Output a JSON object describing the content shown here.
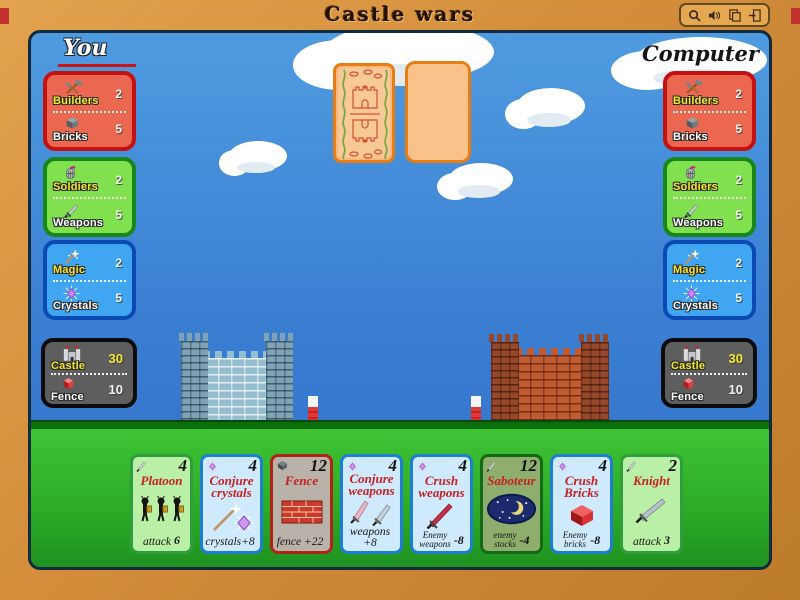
{
  "window": {
    "title": "Castle wars",
    "toolbar": [
      "zoom",
      "sound",
      "cards",
      "exit"
    ]
  },
  "you": {
    "label": "You",
    "panels": [
      {
        "name": "builders-bricks",
        "top_icon": "builders-icon",
        "top_label": "Builders",
        "top_value": "2",
        "bottom_icon": "bricks-icon",
        "bottom_label": "Bricks",
        "bottom_value": "5"
      },
      {
        "name": "soldiers-weapons",
        "top_icon": "soldiers-icon",
        "top_label": "Soldiers",
        "top_value": "2",
        "bottom_icon": "weapons-icon",
        "bottom_label": "Weapons",
        "bottom_value": "5"
      },
      {
        "name": "magic-crystals",
        "top_icon": "magic-icon",
        "top_label": "Magic",
        "top_value": "2",
        "bottom_icon": "crystals-icon",
        "bottom_label": "Crystals",
        "bottom_value": "5"
      },
      {
        "name": "castle-fence",
        "top_icon": "castle-icon",
        "top_label": "Castle",
        "top_value": "30",
        "bottom_icon": "fence-icon",
        "bottom_label": "Fence",
        "bottom_value": "10"
      }
    ]
  },
  "computer": {
    "label": "Computer",
    "panels": [
      {
        "name": "builders-bricks",
        "top_icon": "builders-icon",
        "top_label": "Builders",
        "top_value": "2",
        "bottom_icon": "bricks-icon",
        "bottom_label": "Bricks",
        "bottom_value": "5"
      },
      {
        "name": "soldiers-weapons",
        "top_icon": "soldiers-icon",
        "top_label": "Soldiers",
        "top_value": "2",
        "bottom_icon": "weapons-icon",
        "bottom_label": "Weapons",
        "bottom_value": "5"
      },
      {
        "name": "magic-crystals",
        "top_icon": "magic-icon",
        "top_label": "Magic",
        "top_value": "2",
        "bottom_icon": "crystals-icon",
        "bottom_label": "Crystals",
        "bottom_value": "5"
      },
      {
        "name": "castle-fence",
        "top_icon": "castle-icon",
        "top_label": "Castle",
        "top_value": "30",
        "bottom_icon": "fence-icon",
        "bottom_label": "Fence",
        "bottom_value": "10"
      }
    ]
  },
  "board": {
    "deck_card": "card-back",
    "discard_card": "blank",
    "left_castle_color": "#94bdd0",
    "right_castle_color": "#c05c32"
  },
  "hand": {
    "cards": [
      {
        "title": "Platoon",
        "value": "4",
        "cost_icon": "sword-icon",
        "art": "soldiers",
        "effect_label": "attack",
        "effect_value": "6",
        "color": "green"
      },
      {
        "title": "Conjure crystals",
        "value": "4",
        "cost_icon": "crystal-icon",
        "art": "wand-crystal",
        "effect_label": "crystals+8",
        "effect_value": "",
        "color": "blue"
      },
      {
        "title": "Fence",
        "value": "12",
        "cost_icon": "brick-icon",
        "art": "brick-wall",
        "effect_label": "fence +22",
        "effect_value": "",
        "color": "gray"
      },
      {
        "title": "Conjure weapons",
        "value": "4",
        "cost_icon": "crystal-icon",
        "art": "two-swords",
        "effect_label": "weapons +8",
        "effect_value": "",
        "color": "blue"
      },
      {
        "title": "Crush weapons",
        "value": "4",
        "cost_icon": "crystal-icon",
        "art": "red-sword",
        "effect_label": "Enemy\nweapons",
        "effect_value": "-8",
        "color": "blue"
      },
      {
        "title": "Saboteur",
        "value": "12",
        "cost_icon": "sword-icon",
        "art": "night-moon",
        "effect_label": "enemy\nstocks",
        "effect_value": "-4",
        "color": "olive"
      },
      {
        "title": "Crush Bricks",
        "value": "4",
        "cost_icon": "crystal-icon",
        "art": "red-brick",
        "effect_label": "Enemy\nbricks",
        "effect_value": "-8",
        "color": "blue"
      },
      {
        "title": "Knight",
        "value": "2",
        "cost_icon": "sword-icon",
        "art": "sword",
        "effect_label": "attack",
        "effect_value": "3",
        "color": "green"
      }
    ]
  },
  "colors": {
    "frame": "#d38d3b",
    "sky_top": "#4f9be0",
    "sky_bottom": "#2f6fc6",
    "ground": "#2eae28",
    "panel_red": "#ec6750",
    "panel_green": "#81e04e",
    "panel_blue": "#41a6f2",
    "panel_dark": "#5e5e5e",
    "card_back_border": "#e87d15",
    "title_red": "#c62020",
    "accent_yellow": "#f5e72a"
  }
}
